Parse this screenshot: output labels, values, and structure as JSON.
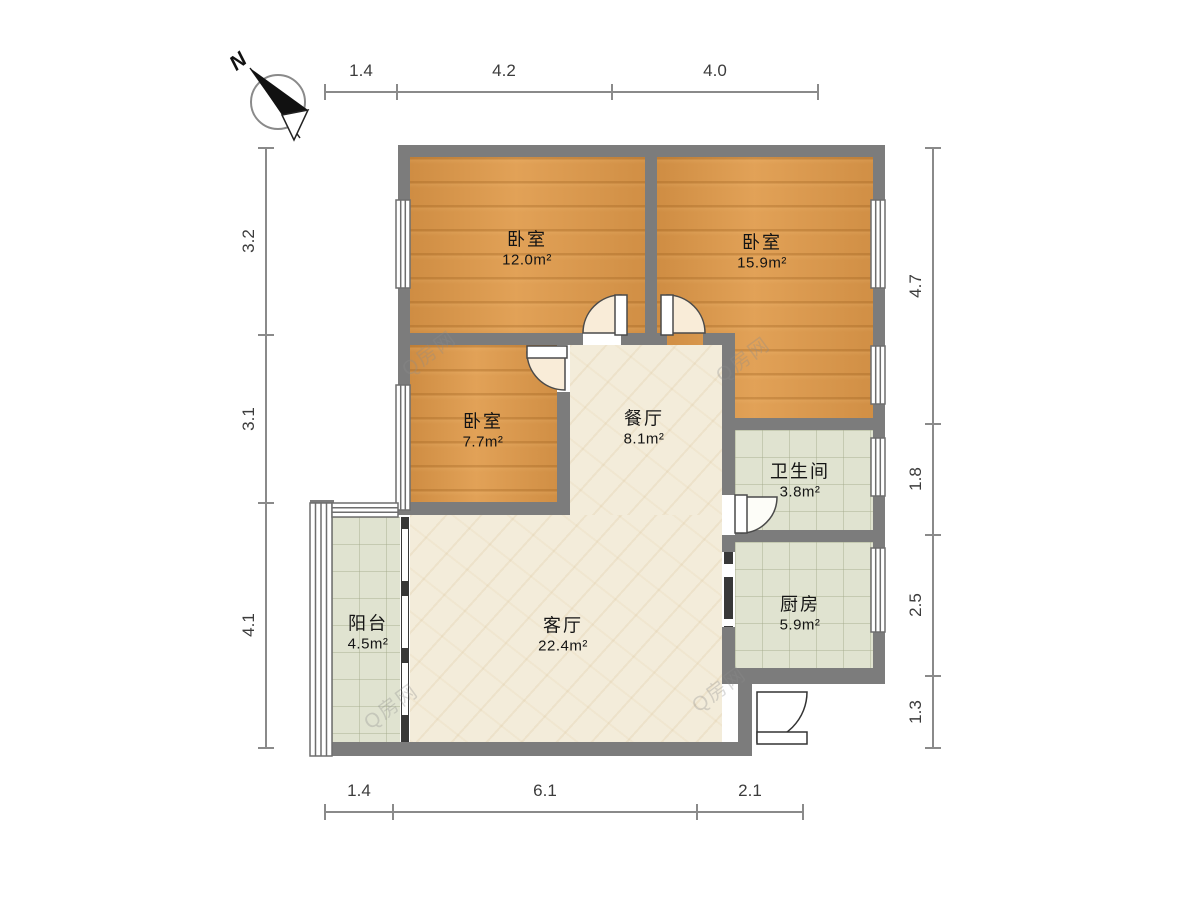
{
  "compass": {
    "label": "N"
  },
  "watermark": {
    "text": "Q房网"
  },
  "rooms": [
    {
      "id": "bedroom-1",
      "name": "卧室",
      "area": "12.0m²"
    },
    {
      "id": "bedroom-2",
      "name": "卧室",
      "area": "15.9m²"
    },
    {
      "id": "bedroom-3",
      "name": "卧室",
      "area": "7.7m²"
    },
    {
      "id": "dining",
      "name": "餐厅",
      "area": "8.1m²"
    },
    {
      "id": "bathroom",
      "name": "卫生间",
      "area": "3.8m²"
    },
    {
      "id": "kitchen",
      "name": "厨房",
      "area": "5.9m²"
    },
    {
      "id": "living",
      "name": "客厅",
      "area": "22.4m²"
    },
    {
      "id": "balcony",
      "name": "阳台",
      "area": "4.5m²"
    }
  ],
  "dimensions": {
    "top": [
      "1.4",
      "4.2",
      "4.0"
    ],
    "bottom": [
      "1.4",
      "6.1",
      "2.1"
    ],
    "left": [
      "3.2",
      "3.1",
      "4.1"
    ],
    "right": [
      "4.7",
      "1.8",
      "2.5",
      "1.3"
    ]
  },
  "colors": {
    "wood": "#dc9b51",
    "marble": "#f3ecda",
    "tile": "#e0e3d0",
    "wall": "#7c7c7c",
    "door-fill": "#f9ecd8"
  }
}
